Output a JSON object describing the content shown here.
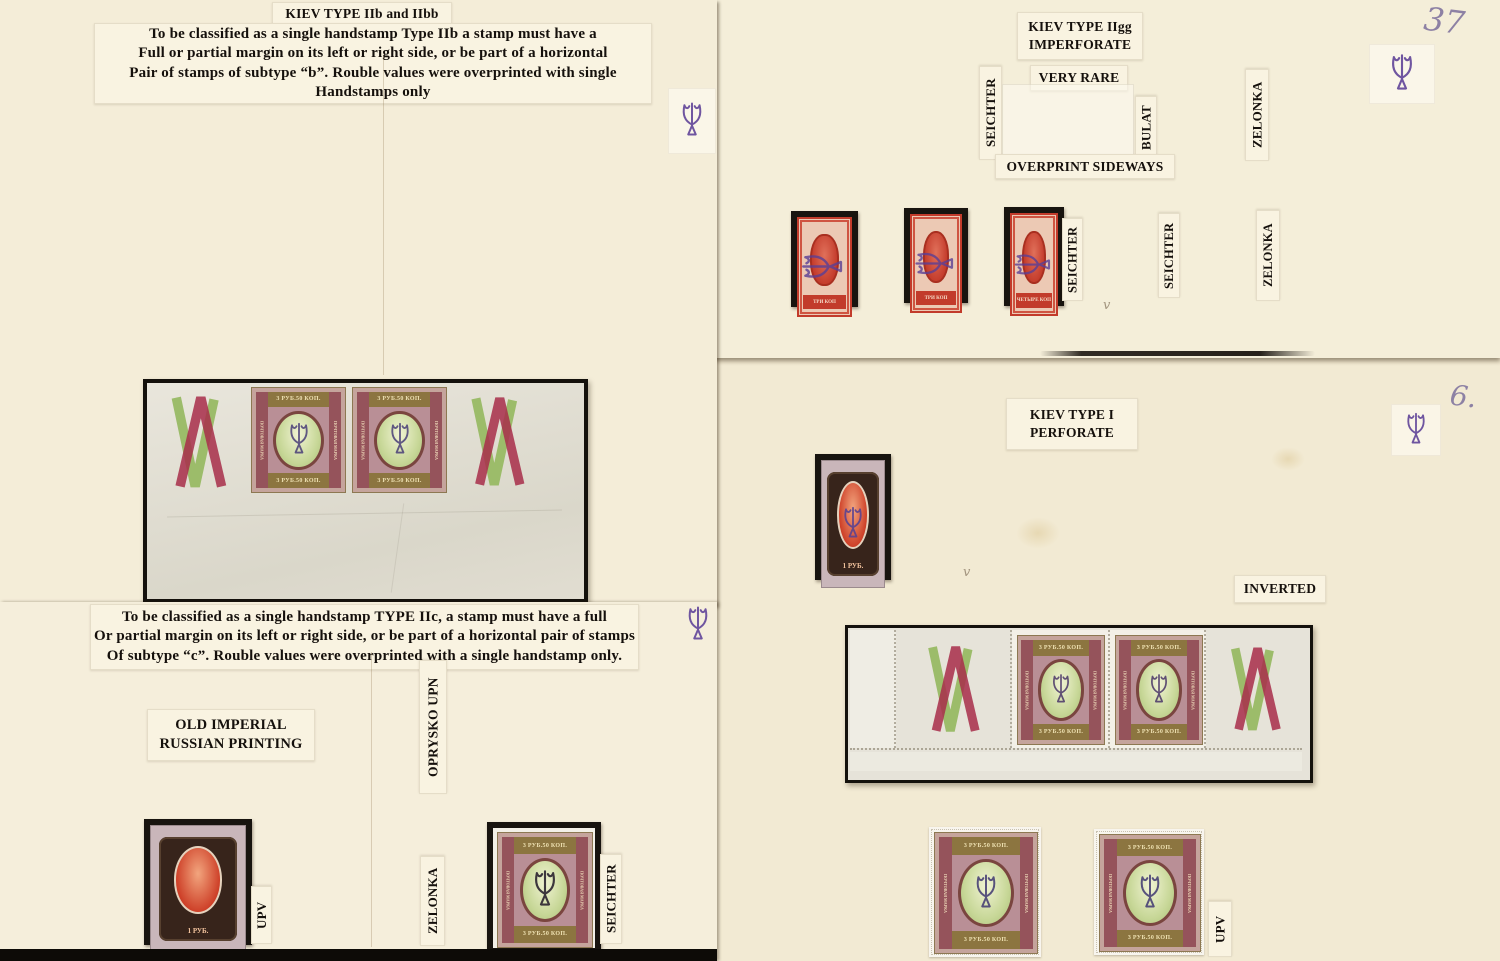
{
  "iib": {
    "title": "KIEV TYPE IIb and IIbb",
    "paragraph": "To be classified as a single handstamp Type IIb a stamp must have a\nFull or partial margin on its left or right side, or be part of a horizontal\nPair of stamps of subtype “b”. Rouble values were overprinted with single\nHandstamps only"
  },
  "iigg": {
    "title": "KIEV TYPE IIgg\nIMPERFORATE",
    "very_rare": "VERY RARE",
    "seichter_left": "SEICHTER",
    "bulat": "BULAT",
    "zelonka_upper": "ZELONKA",
    "overprint_sideways": "OVERPRINT SIDEWAYS",
    "seichter_a": "SEICHTER",
    "seichter_b": "SEICHTER",
    "zelonka_lower": "ZELONKA",
    "page_number": "37"
  },
  "kiev1": {
    "title": "KIEV TYPE I\nPERFORATE",
    "inverted": "INVERTED",
    "upv": "UPV",
    "page_number": "6."
  },
  "iic": {
    "paragraph": "To be classified as a single handstamp TYPE IIc, a stamp must have a full\nOr partial margin on its left or right side, or be part of a horizontal pair of stamps\nOf subtype “c”. Rouble values were overprinted with a single handstamp only.",
    "old_imperial": "OLD IMPERIAL\nRUSSIAN PRINTING",
    "oprysko_upn": "OPRYSKO UPN",
    "upv": "UPV",
    "zelonka": "ZELONKA",
    "seichter": "SEICHTER"
  },
  "stamp_faces": {
    "r350_top": "3 РУБ.50 КОП.",
    "r350_bottom": "3 РУБ.50 КОП.",
    "r350_side": "ПОЧТОВАЯ МАРКА",
    "rub1_value": "1 РУБ.",
    "kop3_value": "ТРИ КОП",
    "kop4_value": "ЧЕТЫРЕ КОП"
  },
  "misc": {
    "pencil_tick": "v"
  },
  "colors": {
    "page_cream": "#f4edd8",
    "mat_black": "#18140f",
    "stamp_red": "#c23b2b",
    "stamp_olive": "#8c7540",
    "stamp_claret": "#95535b",
    "oval_green": "#c7d797",
    "v_mark_red": "#a82e4a",
    "v_mark_green": "#9cbc6a",
    "trident_ink": "#6f55a0"
  }
}
